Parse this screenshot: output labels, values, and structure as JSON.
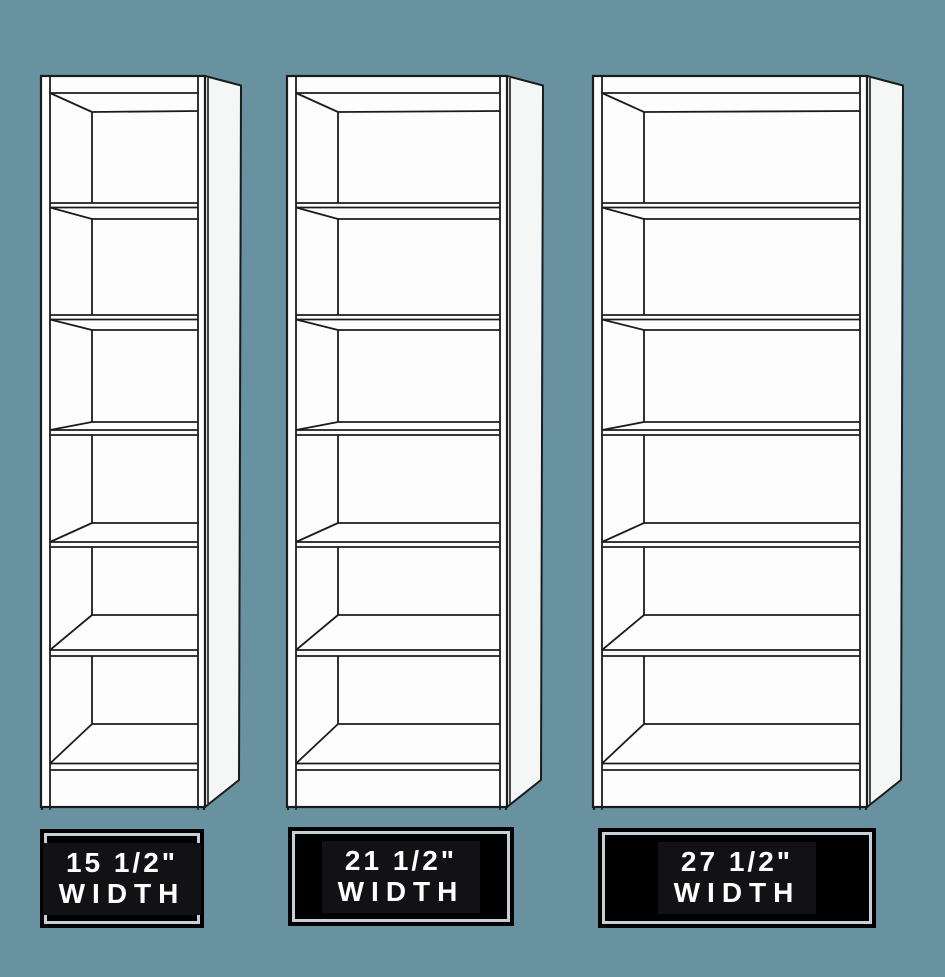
{
  "background_color": "#6992a1",
  "illustration": {
    "bookcases": [
      {
        "name": "bookcase-15-half-inch",
        "shelf_compartments": 6,
        "label": {
          "line1": "15 1/2\"",
          "line2": "WIDTH"
        }
      },
      {
        "name": "bookcase-21-half-inch",
        "shelf_compartments": 6,
        "label": {
          "line1": "21 1/2\"",
          "line2": "WIDTH"
        }
      },
      {
        "name": "bookcase-27-half-inch",
        "shelf_compartments": 6,
        "label": {
          "line1": "27 1/2\"",
          "line2": "WIDTH"
        }
      }
    ],
    "colors": {
      "background": "#6992a1",
      "cabinet_fill": "#fdfdfd",
      "cabinet_side_fill": "#f5f6f6",
      "outline": "#1b1b1b",
      "label_background": "#000000",
      "label_inner_panel": "#121215",
      "label_border_light": "#c5d1d6",
      "label_text": "#ffffff"
    }
  }
}
